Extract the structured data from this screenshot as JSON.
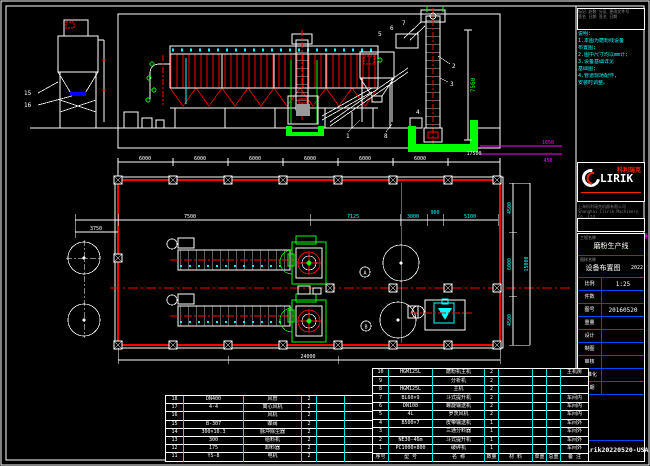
{
  "colors": {
    "line": "#ffffff",
    "red": "#ff0000",
    "green": "#00ff00",
    "cyan": "#00ffff",
    "blue": "#0000ff",
    "magenta": "#ff00ff",
    "grey": "#9a9a9a",
    "logo_red": "#ff2200"
  },
  "rev": {
    "rows": [
      "标记 处数 分区 更改文件号",
      "签名 日期  签名 日期"
    ]
  },
  "notes": {
    "lines": [
      "说明:",
      "1.本图为磨粉线设备",
      "  布置图;",
      "2.图中尺寸均以mm计;",
      "3.设备基础详见",
      "  基础图;",
      "4.管道现场配作,",
      "  安装时调整。"
    ]
  },
  "logo": {
    "name": "LIRIK",
    "cn": "科利瑞克",
    "sub1": "上海科利瑞克机器有限公司",
    "sub2": "Shanghai Clirik Machinery Co.,Ltd."
  },
  "title_block": {
    "project_label": "工程名称",
    "project": "磨粉生产线",
    "drawing_label": "图样名称",
    "drawing": "设备布置图",
    "year": "2022",
    "fields": [
      {
        "label": "比例",
        "value": "1:25"
      },
      {
        "label": "件数",
        "value": ""
      },
      {
        "label": "图号",
        "value": "20160520"
      },
      {
        "label": "重量",
        "value": ""
      }
    ],
    "sign_rows": [
      {
        "label": "设计",
        "value": ""
      },
      {
        "label": "制图",
        "value": ""
      },
      {
        "label": "审核",
        "value": ""
      },
      {
        "label": "标准化",
        "value": ""
      },
      {
        "label": "日期",
        "value": ""
      }
    ],
    "doc_no": "clirik20220520-USA"
  },
  "bom": {
    "headers": [
      "序号",
      "型 号",
      "名 称",
      "数量",
      "材 料",
      "单重",
      "总重",
      "备 注"
    ],
    "right_rows": [
      [
        "10",
        "HGM125L",
        "磨粉机主机",
        "2",
        "",
        "",
        "",
        "主机房"
      ],
      [
        "9",
        "",
        "分析机",
        "2",
        "",
        "",
        "",
        ""
      ],
      [
        "8",
        "HGM125L",
        "主机",
        "2",
        "",
        "",
        "",
        ""
      ],
      [
        "7",
        "BL60×9",
        "斗式提升机",
        "2",
        "",
        "",
        "",
        "车间内"
      ],
      [
        "6",
        "DN108",
        "螺旋输送机",
        "2",
        "",
        "",
        "",
        "车间内"
      ],
      [
        "5",
        "4L",
        "罗茨风机",
        "2",
        "",
        "",
        "",
        "车间内"
      ],
      [
        "4",
        "B500×7",
        "皮带输送机",
        "1",
        "",
        "",
        "",
        "车间外"
      ],
      [
        "3",
        "",
        "三通分料器",
        "1",
        "",
        "",
        "",
        "车间外"
      ],
      [
        "2",
        "NE30-46m",
        "斗式提升机",
        "1",
        "",
        "",
        "",
        "车间外"
      ],
      [
        "1",
        "PC1000×800",
        "破碎机",
        "1",
        "",
        "",
        "",
        "车间外"
      ]
    ],
    "left_rows": [
      [
        "18",
        "DN400",
        "风管",
        "2",
        "",
        "",
        "",
        "主机房"
      ],
      [
        "17",
        "4-4",
        "离心风机",
        "2",
        "",
        "",
        "",
        "主机房"
      ],
      [
        "16",
        "",
        "风机",
        "2",
        "",
        "",
        "",
        ""
      ],
      [
        "15",
        "B-307",
        "蝶阀",
        "2",
        "",
        "",
        "",
        "主机房"
      ],
      [
        "14",
        "300×10.3",
        "脉冲除尘器",
        "2",
        "",
        "",
        "",
        ""
      ],
      [
        "13",
        "300",
        "给料机",
        "2",
        "",
        "",
        "",
        ""
      ],
      [
        "12",
        "175",
        "卸料器",
        "2",
        "",
        "",
        "",
        "主机房"
      ],
      [
        "11",
        "YS-8",
        "电机",
        "2",
        "",
        "",
        "",
        ""
      ]
    ]
  },
  "drawing": {
    "dims": {
      "bay": "6000",
      "top_total": "17500",
      "bottom_total": "24000",
      "left_h": "7500",
      "left_h2": "3750",
      "mid": [
        "7125",
        "3000",
        "900",
        "5100"
      ],
      "right": [
        "4500",
        "6000",
        "4500"
      ],
      "right_total": "15000",
      "elev_height": "7560",
      "pit_w": "1650",
      "pit_d": "450"
    },
    "callouts": [
      "1",
      "2",
      "3",
      "4",
      "5",
      "6",
      "7",
      "8",
      "15",
      "16"
    ],
    "bubbles": [
      "A",
      "B"
    ]
  }
}
